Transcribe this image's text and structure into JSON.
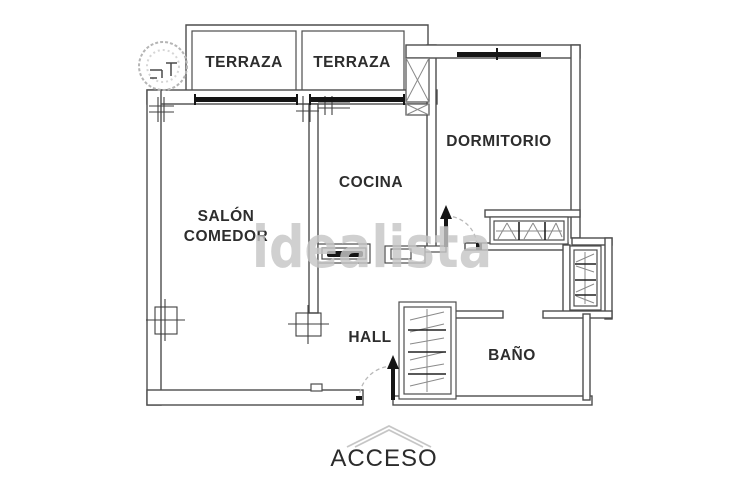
{
  "plan": {
    "watermark": "idealista",
    "labels": {
      "terraza1": "TERRAZA",
      "terraza2": "TERRAZA",
      "dormitorio": "DORMITORIO",
      "cocina": "COCINA",
      "salon_line1": "SALÓN",
      "salon_line2": "COMEDOR",
      "hall": "HALL",
      "bano": "BAÑO",
      "acceso": "ACCESO"
    },
    "colors": {
      "wall_line": "#4d4d4d",
      "window_black": "#151515",
      "light_gray": "#b9b9b9",
      "watermark_gray": "#c6c6c6"
    }
  }
}
